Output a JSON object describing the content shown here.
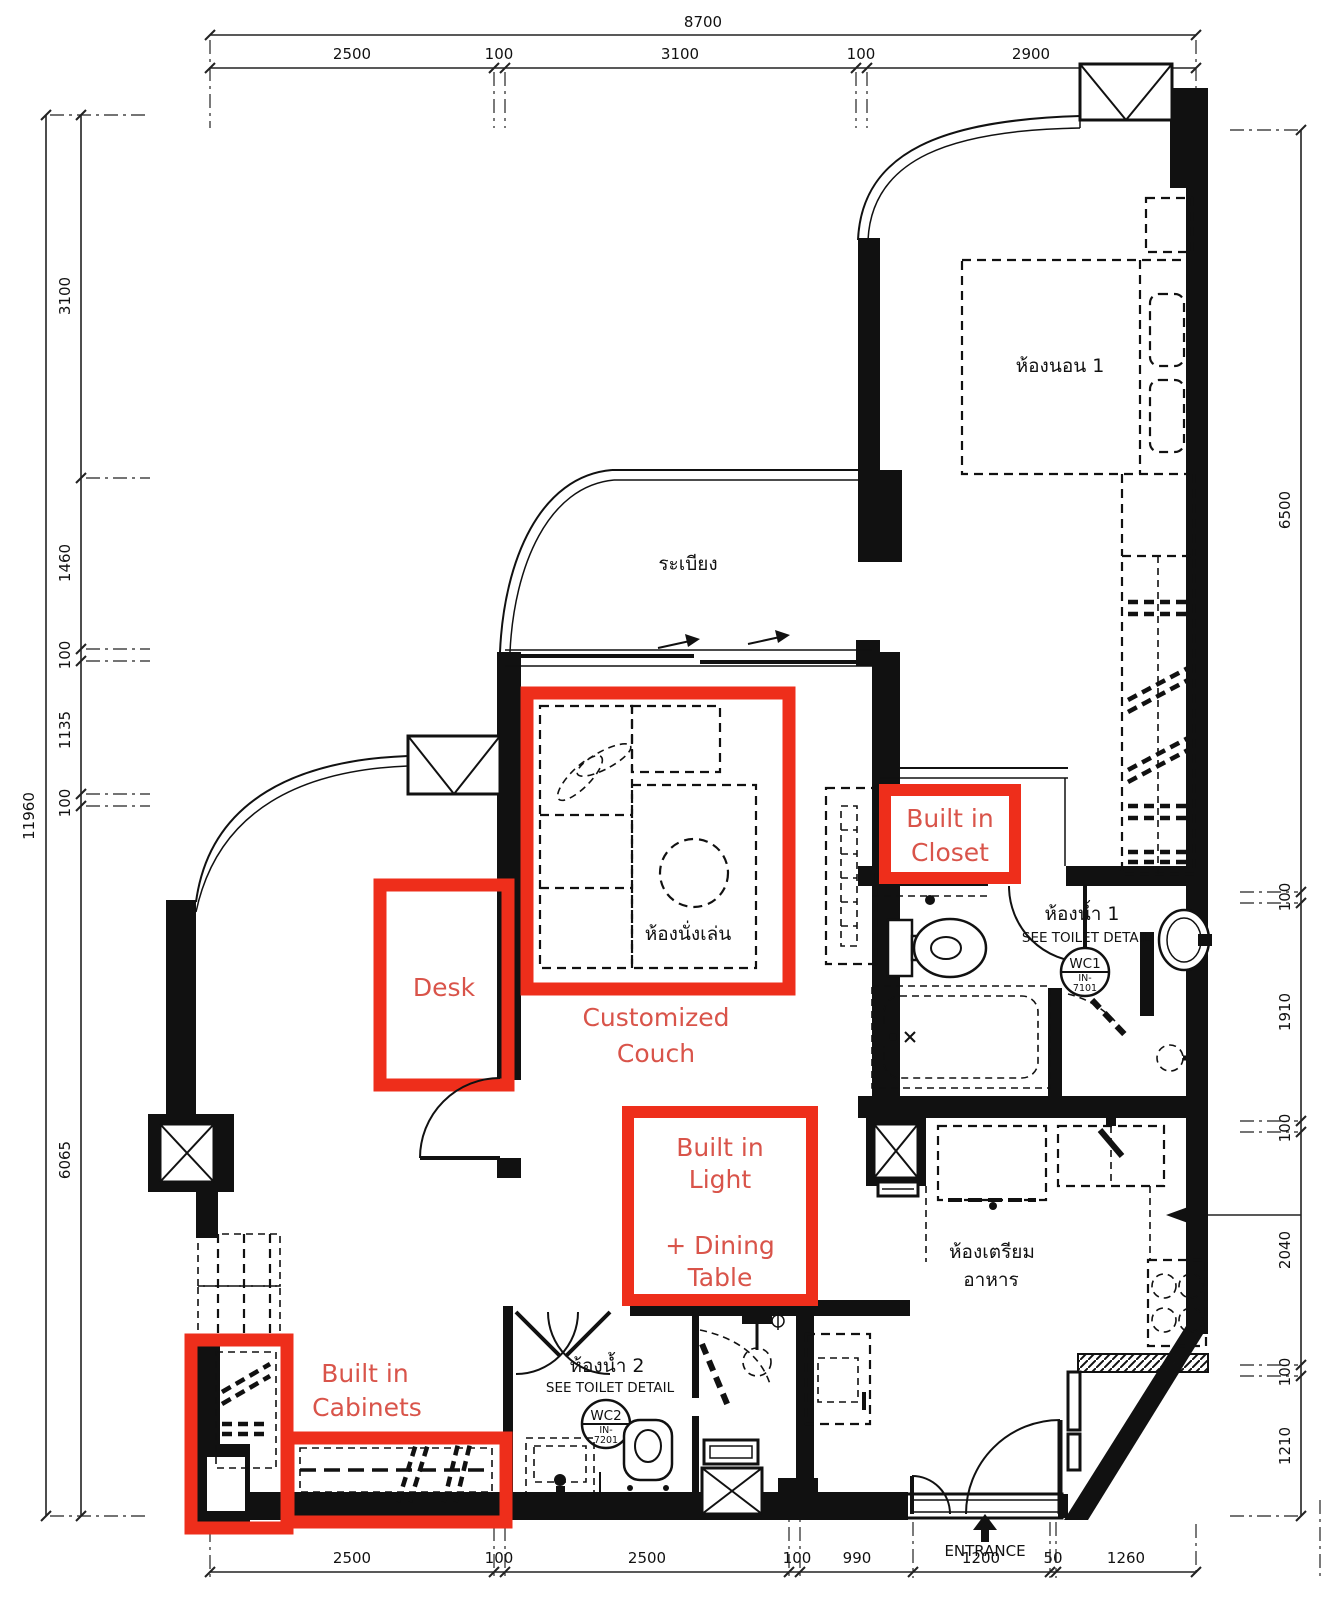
{
  "colors": {
    "background": "#ffffff",
    "wall": "#111111",
    "annotation_box": "#ee2e1b",
    "annotation_text": "#d9544a"
  },
  "dimensions": {
    "top": {
      "total": "8700",
      "segments": [
        "2500",
        "100",
        "3100",
        "100",
        "2900"
      ]
    },
    "left": {
      "total": "11960",
      "segments": [
        "3100",
        "1460",
        "100",
        "1135",
        "100",
        "6065"
      ]
    },
    "right": {
      "segments": [
        "6500",
        "100",
        "1910",
        "100",
        "2040",
        "100",
        "1210"
      ]
    },
    "bottom": {
      "segments": [
        "2500",
        "100",
        "2500",
        "100",
        "990",
        "1200",
        "50",
        "1260"
      ]
    }
  },
  "labels": {
    "bedroom1": "ห้องนอน 1",
    "balcony": "ระเบียง",
    "living_room": "ห้องนั่งเล่น",
    "kitchen_line1": "ห้องเตรียม",
    "kitchen_line2": "อาหาร",
    "bathroom1_name": "ห้องน้ำ 1",
    "bathroom1_note": "SEE TOILET DETAIL",
    "bathroom1_wc": "WC1",
    "bathroom1_code_line1": "IN-",
    "bathroom1_code_line2": "7101",
    "bathroom2_name": "ห้องน้ำ 2",
    "bathroom2_note": "SEE TOILET DETAIL",
    "bathroom2_wc": "WC2",
    "bathroom2_code_line1": "IN-",
    "bathroom2_code_line2": "7201",
    "entrance": "ENTRANCE"
  },
  "annotations": {
    "desk": "Desk",
    "couch_line1": "Customized",
    "couch_line2": "Couch",
    "closet_line1": "Built in",
    "closet_line2": "Closet",
    "light_line1": "Built in",
    "light_line2": "Light",
    "light_line3": "+ Dining",
    "light_line4": "Table",
    "cabinets_line1": "Built in",
    "cabinets_line2": "Cabinets"
  }
}
